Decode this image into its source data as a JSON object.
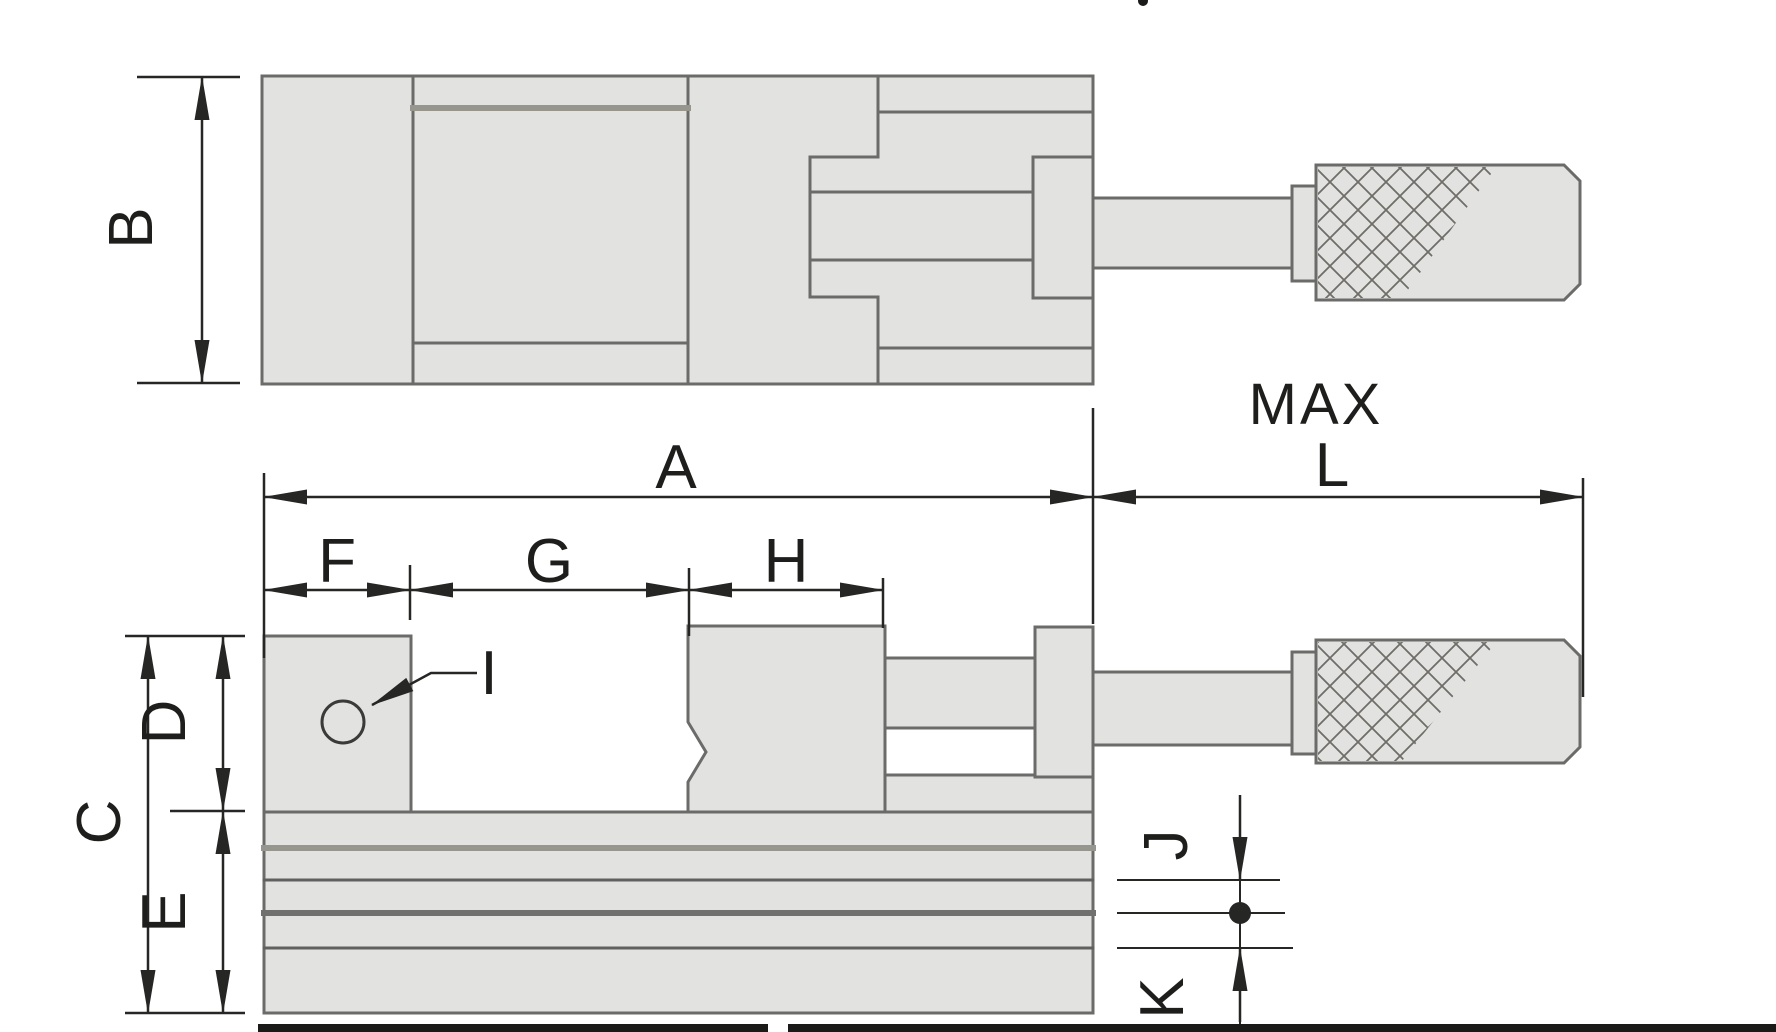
{
  "drawing": {
    "kind": "technical-dimension-drawing",
    "subject": "precision toolmaker vise, top view and side view with dimension callouts",
    "labels": {
      "A": "A",
      "B": "B",
      "C": "C",
      "D": "D",
      "E": "E",
      "F": "F",
      "G": "G",
      "H": "H",
      "I": "I",
      "J": "J",
      "K": "K",
      "L": "L",
      "max": "MAX"
    },
    "dimension_ids": [
      "A",
      "B",
      "C",
      "D",
      "E",
      "F",
      "G",
      "H",
      "I",
      "J",
      "K",
      "L"
    ],
    "colors": {
      "background": "#ffffff",
      "part_fill": "#e2e2e0",
      "part_outline": "#6b6b69",
      "soft_line": "#96968f",
      "dimension": "#262624",
      "text": "#1e1e1c"
    }
  }
}
